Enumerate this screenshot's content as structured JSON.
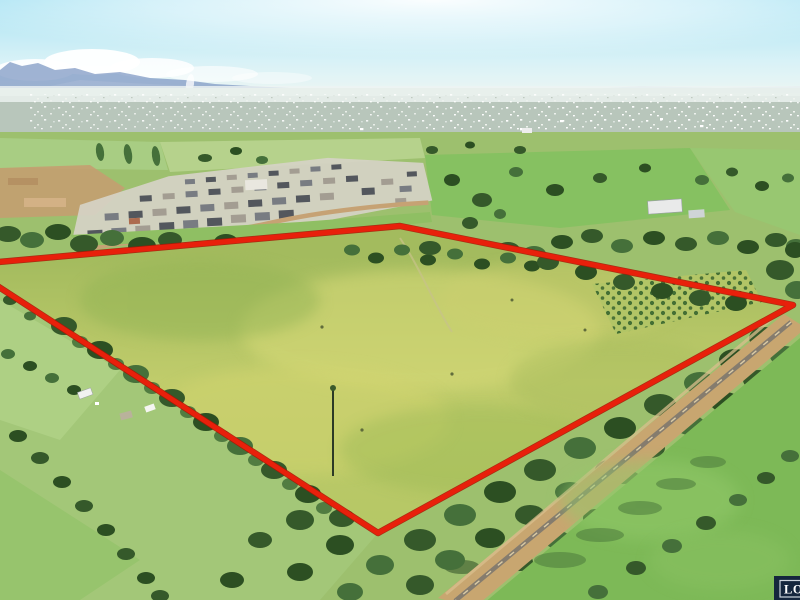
{
  "watermark": {
    "text": "LO",
    "background": "#15263d",
    "frame_color": "#ccd3db",
    "text_color": "#ffffff"
  },
  "boundary": {
    "points": "-12,263 400,226 793,305 378,533 -12,280",
    "stroke": "#e8200b",
    "outline": "#a81504",
    "stroke_width": 5
  },
  "palette": {
    "sky_top": "#a9e3f3",
    "sky_mid": "#d9f2f7",
    "sky_horizon": "#edf6f3",
    "mountain": "#8099c4",
    "mountain_far": "#a9b9d6",
    "cloud": "#ffffff",
    "haze_land": "#ccdccf",
    "field_base": "#9dc06e",
    "field_bright": "#86c161",
    "field_light": "#b6d28c",
    "field_left": "#a8cd83",
    "field_right": "#98c771",
    "outside_left": "#a3c778",
    "paddock_bottom_right": "#7db957",
    "meadow_top": "#a3bb5e",
    "meadow_mid": "#c0cc6b",
    "meadow_low": "#b5c765",
    "railway_corridor": "#c8a670",
    "railway_track": "#857c6e",
    "dirt": "#c49e70",
    "estate_ground": "#d6d2c6"
  }
}
